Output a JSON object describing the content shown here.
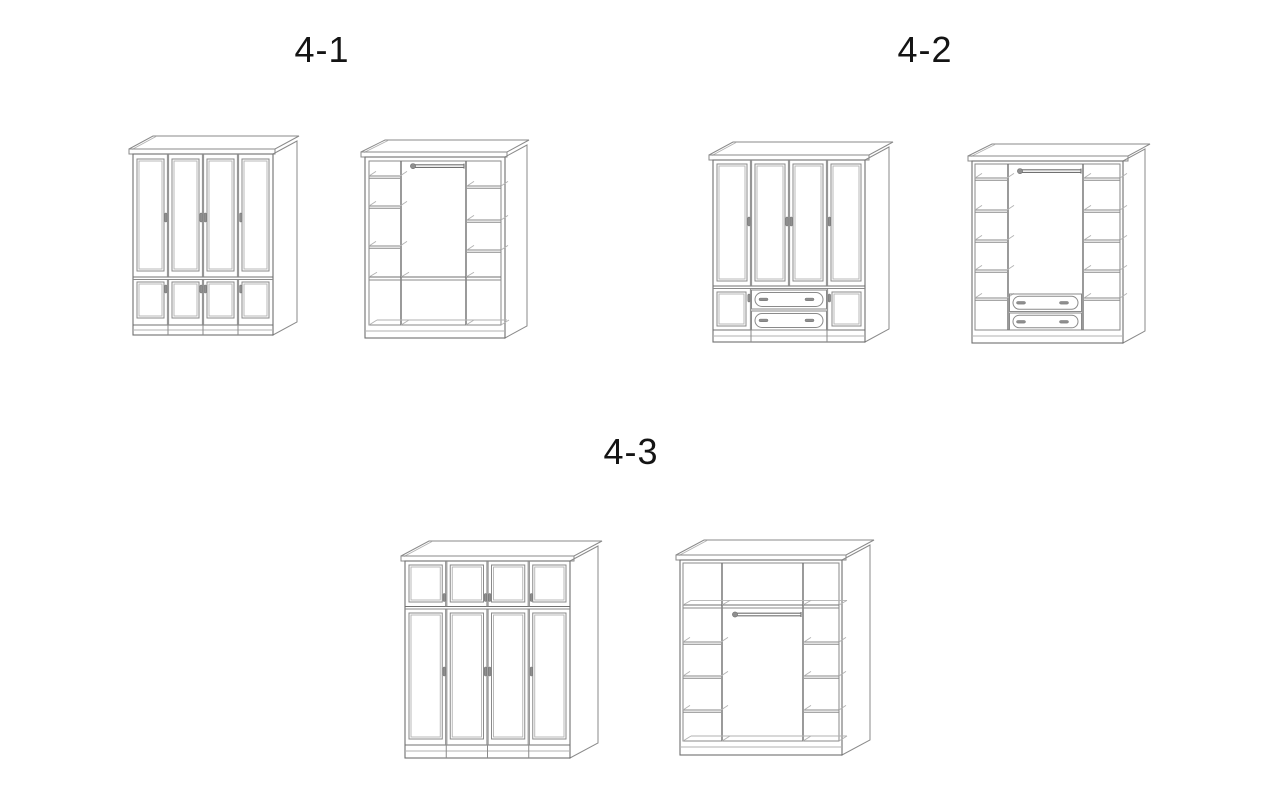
{
  "figures": [
    {
      "label": "4-1"
    },
    {
      "label": "4-2"
    },
    {
      "label": "4-3"
    }
  ],
  "palette": {
    "background": "#ffffff",
    "line": "#8a8a8a",
    "line_strong": "#707070",
    "line_light": "#b2b2b2",
    "handle": "#8f8f8f",
    "text": "#141414"
  }
}
